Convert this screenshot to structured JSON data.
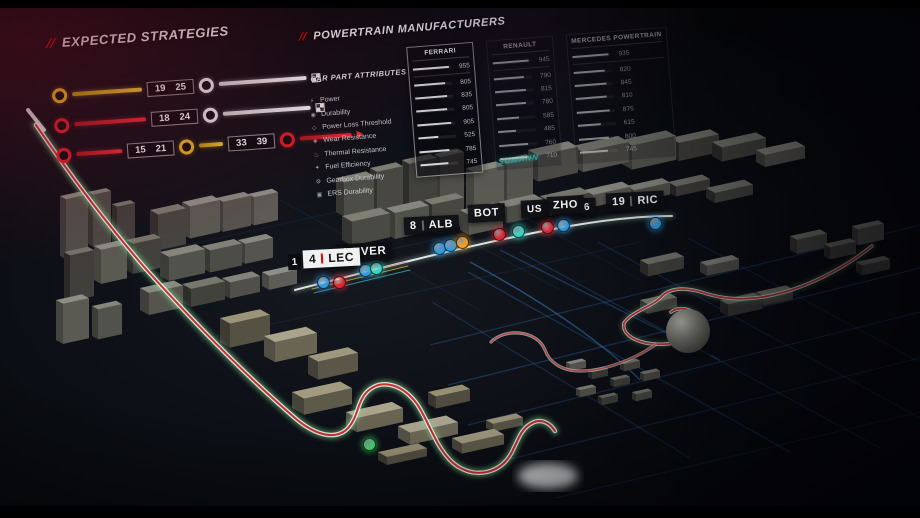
{
  "strategies": {
    "marker": "//",
    "title": "EXPECTED STRATEGIES",
    "row1": {
      "a": "19",
      "b": "25"
    },
    "row2": {
      "a": "18",
      "b": "24"
    },
    "row3": {
      "a": "15",
      "b": "21",
      "c": "33",
      "d": "39"
    }
  },
  "powertrain": {
    "marker": "//",
    "title": "POWERTRAIN MANUFACTURERS",
    "attributes_header": "CAR PART ATTRIBUTES",
    "attributes": [
      {
        "label": "Power",
        "icon": "⚡"
      },
      {
        "label": "Durability",
        "icon": "◉"
      },
      {
        "label": "Power Loss Threshold",
        "icon": "◇"
      },
      {
        "label": "Wear Resistance",
        "icon": "◈"
      },
      {
        "label": "Thermal Resistance",
        "icon": "♨"
      },
      {
        "label": "Fuel Efficiency",
        "icon": "✦"
      },
      {
        "label": "Gearbox Durability",
        "icon": "⚙"
      },
      {
        "label": "ERS Durability",
        "icon": "▣"
      }
    ],
    "max_value": 1000,
    "manufacturers": [
      {
        "name": "FERRARI",
        "selected": true,
        "values": [
          955,
          805,
          835,
          805,
          905,
          525,
          785,
          745
        ]
      },
      {
        "name": "RENAULT",
        "selected": false,
        "values": [
          945,
          790,
          815,
          780,
          585,
          485,
          760,
          710
        ]
      },
      {
        "name": "MERCEDES POWERTRAIN",
        "selected": false,
        "values": [
          935,
          820,
          845,
          810,
          875,
          615,
          800,
          745
        ]
      }
    ]
  },
  "map": {
    "teal_sign": "SUMANN",
    "driver_tags": [
      {
        "id": "ver",
        "number": "1",
        "tla": "VER",
        "style": "dark"
      },
      {
        "id": "lec",
        "prefix": "1",
        "number": "4",
        "tla": "LEC",
        "style": "light"
      },
      {
        "id": "alb",
        "number": "8",
        "tla": "ALB",
        "style": "dark"
      },
      {
        "id": "bot",
        "number": "",
        "tla": "BOT",
        "style": "dark"
      },
      {
        "id": "rus",
        "number": "",
        "tla": "US",
        "style": "dark"
      },
      {
        "id": "zho",
        "number": "",
        "tla": "ZHO",
        "style": "dark"
      },
      {
        "id": "frag",
        "number": "",
        "tla": "6",
        "style": "dark"
      },
      {
        "id": "ric",
        "number": "19",
        "tla": "RIC",
        "style": "dark"
      }
    ],
    "gems": [
      {
        "x": 322,
        "y": 281,
        "color": "blue"
      },
      {
        "x": 338,
        "y": 281,
        "color": "red"
      },
      {
        "x": 364,
        "y": 269,
        "color": "blue"
      },
      {
        "x": 375,
        "y": 267,
        "color": "teal"
      },
      {
        "x": 438,
        "y": 247,
        "color": "blue"
      },
      {
        "x": 449,
        "y": 244,
        "color": "blue"
      },
      {
        "x": 461,
        "y": 241,
        "color": "orange"
      },
      {
        "x": 498,
        "y": 233,
        "color": "red"
      },
      {
        "x": 517,
        "y": 230,
        "color": "teal"
      },
      {
        "x": 546,
        "y": 226,
        "color": "red"
      },
      {
        "x": 562,
        "y": 224,
        "color": "blue"
      },
      {
        "x": 654,
        "y": 222,
        "color": "blue"
      },
      {
        "x": 368,
        "y": 443,
        "color": "green"
      }
    ],
    "colors": {
      "blue": "#2f9ae0",
      "red": "#e02330",
      "orange": "#f59c20",
      "teal": "#35d3c0",
      "green": "#3ddc6a",
      "accent": "#e10600",
      "track_red": "#c22828",
      "track_green": "#7fdd92",
      "grid_blue": "#2e5f9e"
    }
  }
}
